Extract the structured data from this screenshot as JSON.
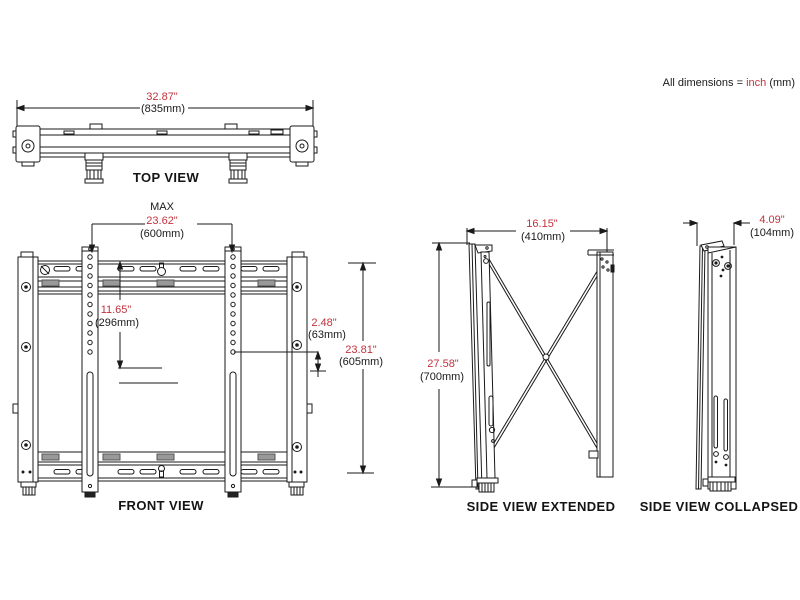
{
  "note": {
    "prefix": "All dimensions = ",
    "unit": "inch",
    "suffix": " (mm)"
  },
  "colors": {
    "dimension_inch_red": "#c2323d",
    "line": "#1a1a1a",
    "clip_gray": "#999999",
    "background": "#ffffff"
  },
  "views": {
    "top": {
      "label": "TOP VIEW",
      "width": {
        "inch": "32.87\"",
        "mm": "(835mm)"
      }
    },
    "front": {
      "label": "FRONT VIEW",
      "max_hole_width": {
        "prefix": "MAX",
        "inch": "23.62\"",
        "mm": "(600mm)"
      },
      "hole_height": {
        "inch": "11.65\"",
        "mm": "(296mm)"
      },
      "lower_hole_offset": {
        "inch": "2.48\"",
        "mm": "(63mm)"
      },
      "total_height": {
        "inch": "23.81\"",
        "mm": "(605mm)"
      }
    },
    "side_extended": {
      "label": "SIDE VIEW EXTENDED",
      "depth": {
        "inch": "16.15\"",
        "mm": "(410mm)"
      },
      "height": {
        "inch": "27.58\"",
        "mm": "(700mm)"
      }
    },
    "side_collapsed": {
      "label": "SIDE VIEW COLLAPSED",
      "depth": {
        "inch": "4.09\"",
        "mm": "(104mm)"
      }
    }
  }
}
